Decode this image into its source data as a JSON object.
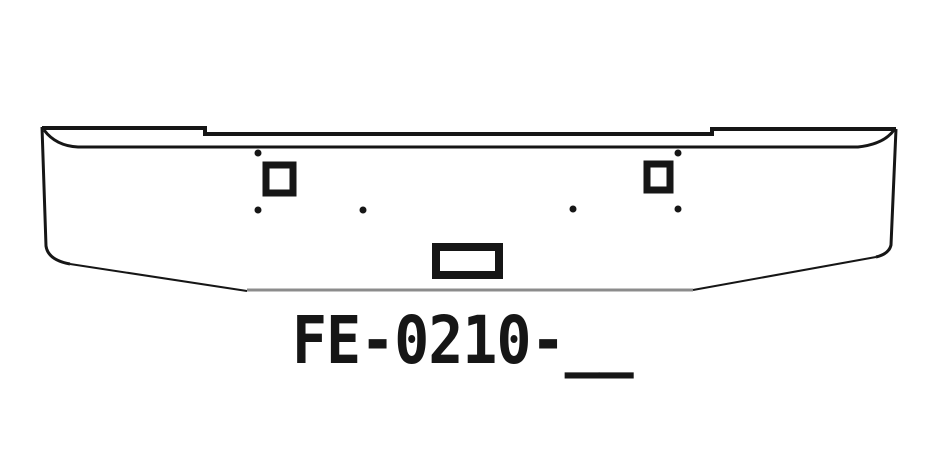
{
  "figure": {
    "part_label": "FE-0210-__"
  },
  "colors": {
    "background": "#ffffff",
    "line": "#161616",
    "bottom_edge": "#8c8c8c"
  }
}
